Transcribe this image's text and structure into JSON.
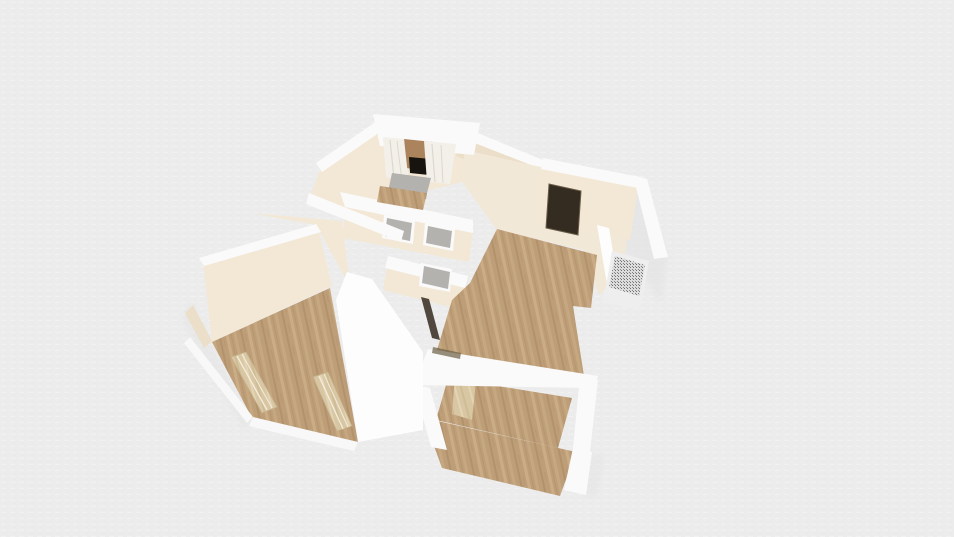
{
  "scene": {
    "view": "3d-floor-plan-render",
    "background_color": "#ececec",
    "grid_line_light": "#f3f3f3",
    "grid_line_dark": "#e4e4e4",
    "colors": {
      "background": "#ececec",
      "wall_cap": "#fafafa",
      "wall_bright": "#fdfdfd",
      "wall_face": "#f3e8d6",
      "wall_face_shaded": "#ecdfc9",
      "floor_cream": "#f1e8d8",
      "floor_wood": "#bd9e78",
      "wood_streak_light": "#cbae86",
      "wood_streak_dark": "#ad8d66",
      "door_dark": "#352c21",
      "door_frame": "#6b5d49",
      "door_panel_wood": "#d9c7a4",
      "door_panel_stripe": "#cdbb94",
      "window_black": "#17140f",
      "window_wall_brown": "#ab835d",
      "curtain": "#f3f0e9",
      "curtain_fold": "#ddd8cd",
      "sill_gray": "#b4b2af",
      "sill_gray_front": "#9b9996",
      "radiator_frame": "#eeeeee",
      "radiator_body": "#dcdcdc",
      "radiator_mesh_dot": "#707070",
      "threshold_dark": "#6b6045",
      "shadow": "#e2e2e2",
      "trim_white": "#f8f8f8"
    },
    "objects": {
      "bay_window": "bay-window-with-curtains",
      "dark_door": "dark-interior-door",
      "radiator": "wall-radiator",
      "pass_window_count": 3,
      "leaning_door_count": 2,
      "terrace": "wood-deck"
    },
    "rooms": [
      {
        "name": "top-room",
        "floor": "wood"
      },
      {
        "name": "upper-right-room",
        "floor": "cream"
      },
      {
        "name": "center-room",
        "floor": "wood"
      },
      {
        "name": "left-room",
        "floor": "wood"
      },
      {
        "name": "bottom-room",
        "floor": "wood"
      },
      {
        "name": "hallway",
        "floor": "hidden"
      }
    ]
  }
}
